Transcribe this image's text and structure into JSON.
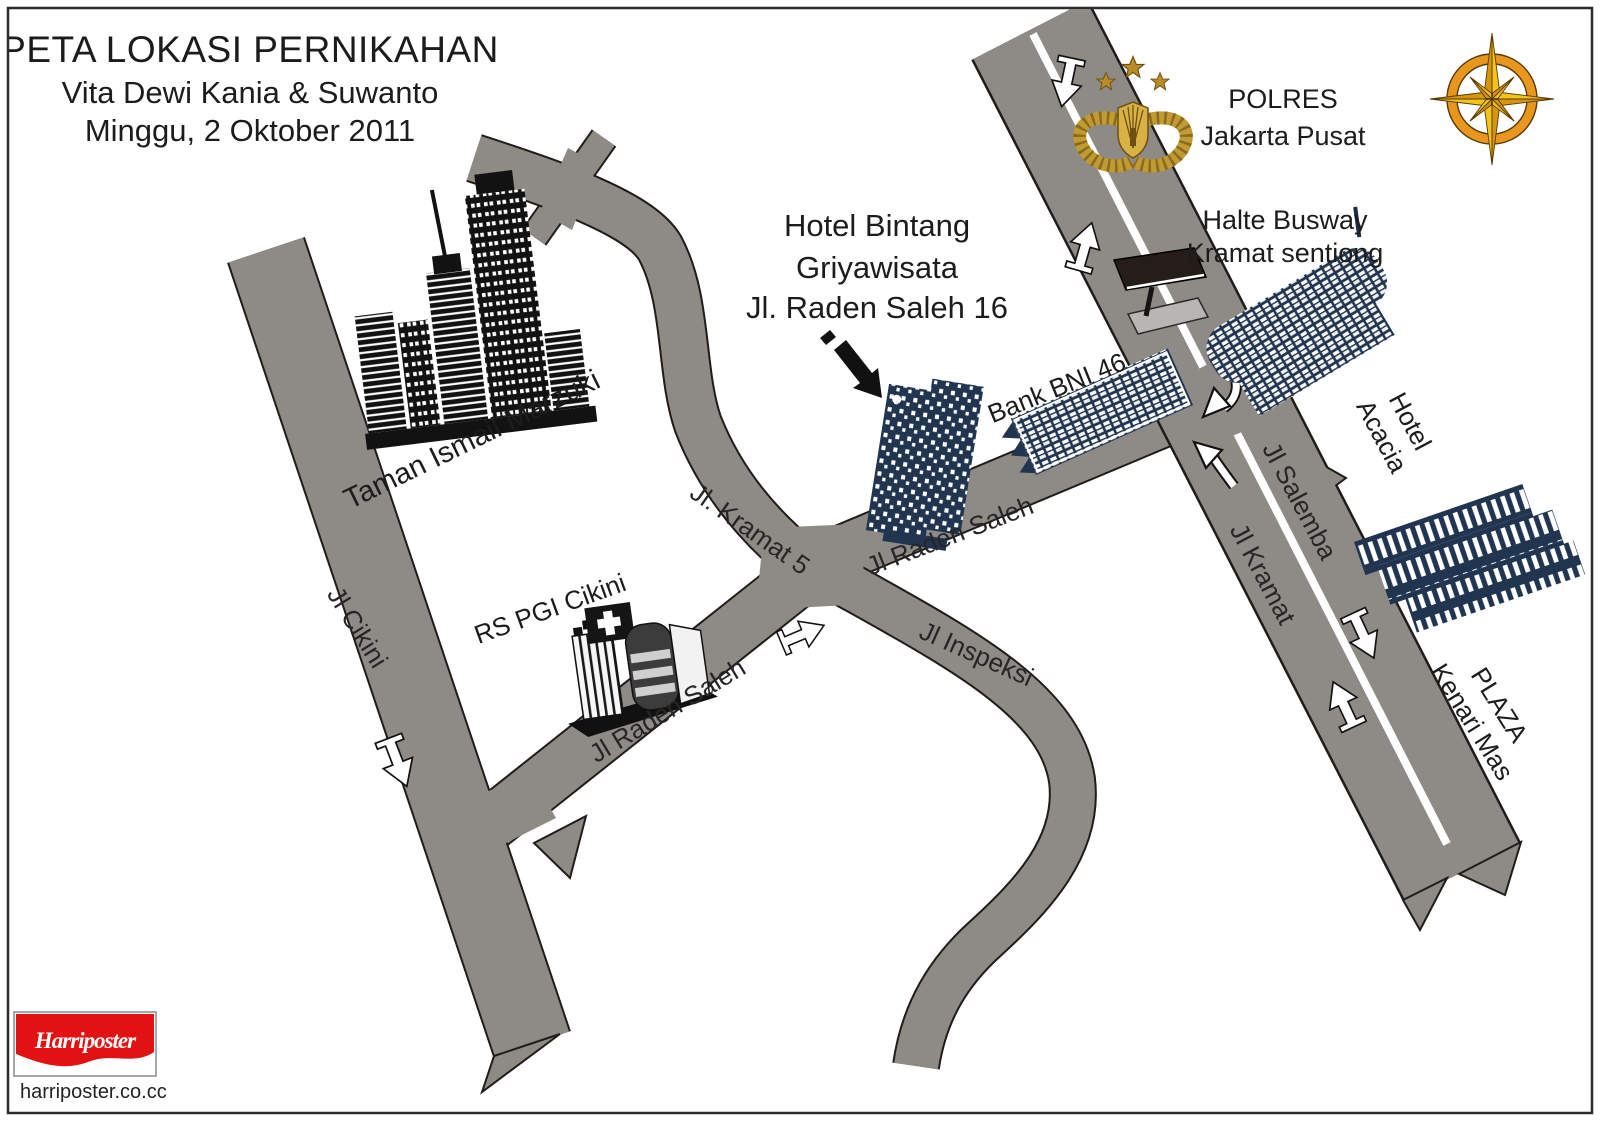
{
  "map_title": {
    "line1": "PETA LOKASI PERNIKAHAN",
    "line2": "Vita Dewi Kania & Suwanto",
    "line3": "Minggu, 2 Oktober 2011"
  },
  "landmarks": {
    "polres": {
      "line1": "POLRES",
      "line2": "Jakarta Pusat"
    },
    "halte_busway": {
      "line1": "Halte Busway",
      "line2": "Kramat sentiong"
    },
    "hotel_bintang": {
      "line1": "Hotel Bintang",
      "line2": "Griyawisata",
      "line3": "Jl. Raden Saleh 16"
    },
    "bank_bni": {
      "label": "Bank BNI 46"
    },
    "hotel_acacia": {
      "line1": "Hotel",
      "line2": "Acacia"
    },
    "plaza_kenari": {
      "line1": "PLAZA",
      "line2": "Kenari Mas"
    },
    "taman_ismail": {
      "label": "Taman Ismail Marzuki"
    },
    "rs_pgi": {
      "label": "RS PGI Cikini"
    }
  },
  "roads": {
    "jl_cikini": "Jl Cikini",
    "jl_kramat5": "Jl. Kramat 5",
    "jl_raden_saleh_upper": "Jl Raden Saleh",
    "jl_raden_saleh_lower": "Jl Raden Saleh",
    "jl_inspeksi": "Jl Inspeksi",
    "jl_salemba": "Jl Salemba",
    "jl_kramat": "Jl Kramat"
  },
  "footer": {
    "logo_text": "Harriposter",
    "website": "harriposter.co.cc"
  },
  "colors": {
    "road_gray": "#8e8a86",
    "building_navy": "#213551",
    "building_black": "#121212",
    "compass_gold": "#f2c31d",
    "compass_gold_dark": "#d6950e",
    "compass_ring": "#e8961e",
    "police_gold": "#c09a33",
    "logo_red": "#e21212"
  }
}
